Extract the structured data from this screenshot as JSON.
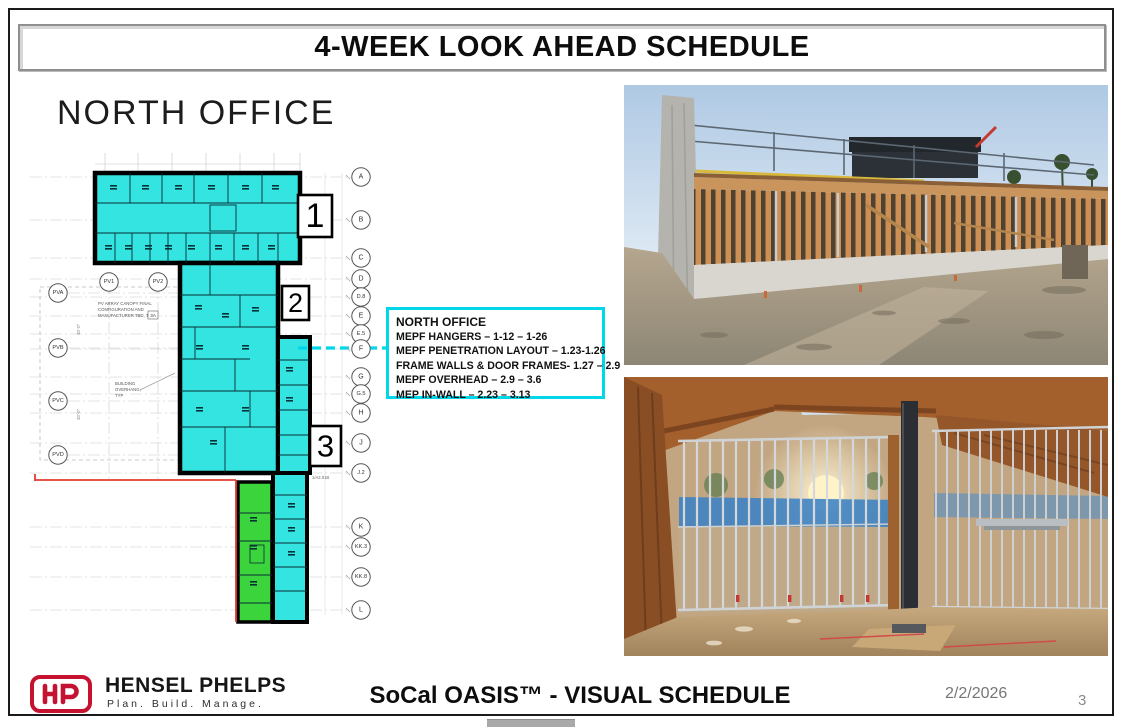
{
  "slide": {
    "title": "4-WEEK LOOK AHEAD SCHEDULE",
    "date": "2/2/2026",
    "page_number": "3"
  },
  "plan": {
    "heading": "NORTH OFFICE",
    "area_markers": [
      "1",
      "2",
      "3"
    ],
    "grid_bubbles_right": [
      "A",
      "B",
      "C",
      "D",
      "D.8",
      "E",
      "E.5",
      "F",
      "G",
      "G.5",
      "H",
      "J",
      "J.2",
      "K",
      "KK.3",
      "KK.8",
      "L"
    ],
    "grid_bubbles_left": [
      "PVA",
      "PVB",
      "PVC",
      "PVD"
    ],
    "grid_bubbles_top": [
      "PV1",
      "PV2"
    ],
    "annotation_canopy": [
      "PV ARRAY CANOPY FINAL",
      "CONFIGURATION AND",
      "MANUFACTURER TBD, TYP."
    ],
    "annotation_canopy_tag": "3A",
    "annotation_overhang": [
      "BUILDING",
      "OVERHANG,",
      "TYP"
    ],
    "detail_ref": "1/A2.01B",
    "dimension_labels": [
      "30'-0\"",
      "30'-0\""
    ],
    "highlight_cyan": "#33e4e1",
    "highlight_green": "#3cd43c",
    "redline_color": "#e23b30"
  },
  "callout": {
    "title": "NORTH OFFICE",
    "lines": [
      "MEPF HANGERS – 1-12 – 1-26",
      "MEPF PENETRATION LAYOUT – 1.23-1.26",
      "FRAME WALLS & DOOR FRAMES- 1.27 – 2.9",
      "MEPF OVERHEAD – 2.9 – 3.6",
      "MEP IN-WALL – 2.23 – 3.13"
    ],
    "border_color": "#00d8ea"
  },
  "footer": {
    "logo_monogram": "HP",
    "company": "HENSEL PHELPS",
    "tagline": "Plan. Build. Manage.",
    "project": "SoCal OASIS™ - VISUAL SCHEDULE",
    "brand_red": "#c41230"
  }
}
